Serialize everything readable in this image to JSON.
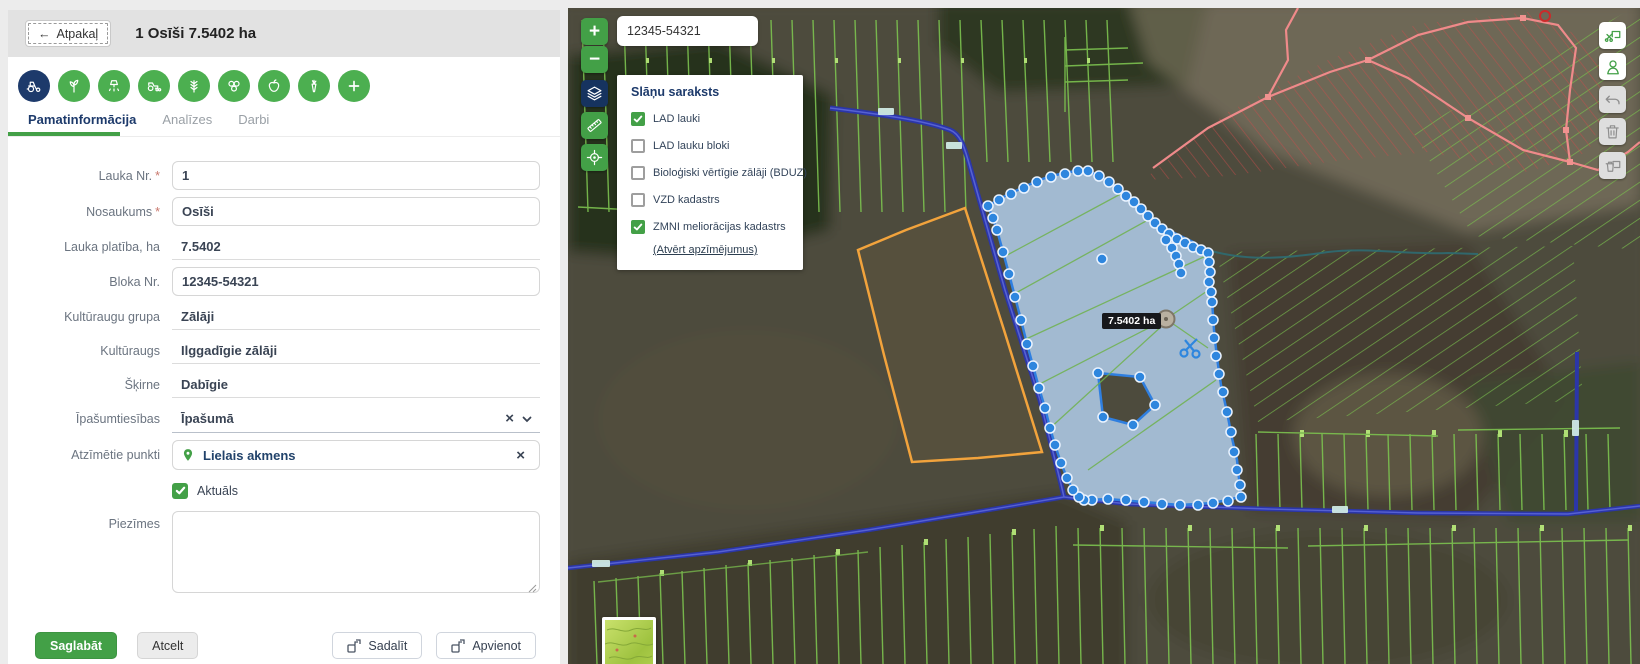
{
  "header": {
    "back_label": "Atpakaļ",
    "title": "1 Osīši 7.5402 ha"
  },
  "action_icons": [
    "tractor",
    "sprout",
    "spraying",
    "seeder",
    "wheat",
    "bales",
    "apple",
    "carrot",
    "add"
  ],
  "tabs": [
    {
      "label": "Pamatinformācija",
      "active": true
    },
    {
      "label": "Analīzes",
      "active": false
    },
    {
      "label": "Darbi",
      "active": false
    }
  ],
  "form": {
    "lauka_nr": {
      "label": "Lauka Nr.",
      "required": "*",
      "value": "1"
    },
    "nosaukums": {
      "label": "Nosaukums",
      "required": "*",
      "value": "Osīši"
    },
    "platiba": {
      "label": "Lauka platība, ha",
      "value": "7.5402"
    },
    "bloka_nr": {
      "label": "Bloka Nr.",
      "value": "12345-54321"
    },
    "kult_grupa": {
      "label": "Kultūraugu grupa",
      "value": "Zālāji"
    },
    "kulturaugs": {
      "label": "Kultūraugs",
      "value": "Ilggadīgie zālāji"
    },
    "skirne": {
      "label": "Šķirne",
      "value": "Dabīgie"
    },
    "ipasumtiesibas": {
      "label": "Īpašumtiesības",
      "value": "Īpašumā",
      "clear_icon": "×"
    },
    "atzimetie": {
      "label": "Atzīmētie punkti",
      "value": "Lielais akmens",
      "clear_icon": "×"
    },
    "aktuals": {
      "label": "Aktuāls",
      "checked": true
    },
    "piezimes": {
      "label": "Piezīmes",
      "value": ""
    }
  },
  "buttons": {
    "save": "Saglabāt",
    "cancel": "Atcelt",
    "split": "Sadalīt",
    "merge": "Apvienot"
  },
  "map": {
    "search_value": "12345-54321",
    "area_tooltip": "7.5402 ha",
    "zoom_in": "+",
    "zoom_out": "−",
    "layers_panel": {
      "title": "Slāņu saraksts",
      "items": [
        {
          "label": "LAD lauki",
          "checked": true
        },
        {
          "label": "LAD lauku bloki",
          "checked": false
        },
        {
          "label": "Bioloģiski vērtīgie zālāji (BDUZ)",
          "checked": false
        },
        {
          "label": "VZD kadastrs",
          "checked": false
        },
        {
          "label": "ZMNI meliorācijas kadastrs",
          "checked": true
        }
      ],
      "legend_link": "(Atvērt apzīmējumus)"
    }
  },
  "colors": {
    "accent_green": "#43a047",
    "navy": "#1d3a6b",
    "selection_blue": "#2e86de",
    "selection_fill": "#b5d3f1",
    "orange_outline": "#f2a33c",
    "road_blue": "#2b36a8",
    "drain_green": "#7cc24f",
    "red_network": "#d14b4b"
  }
}
